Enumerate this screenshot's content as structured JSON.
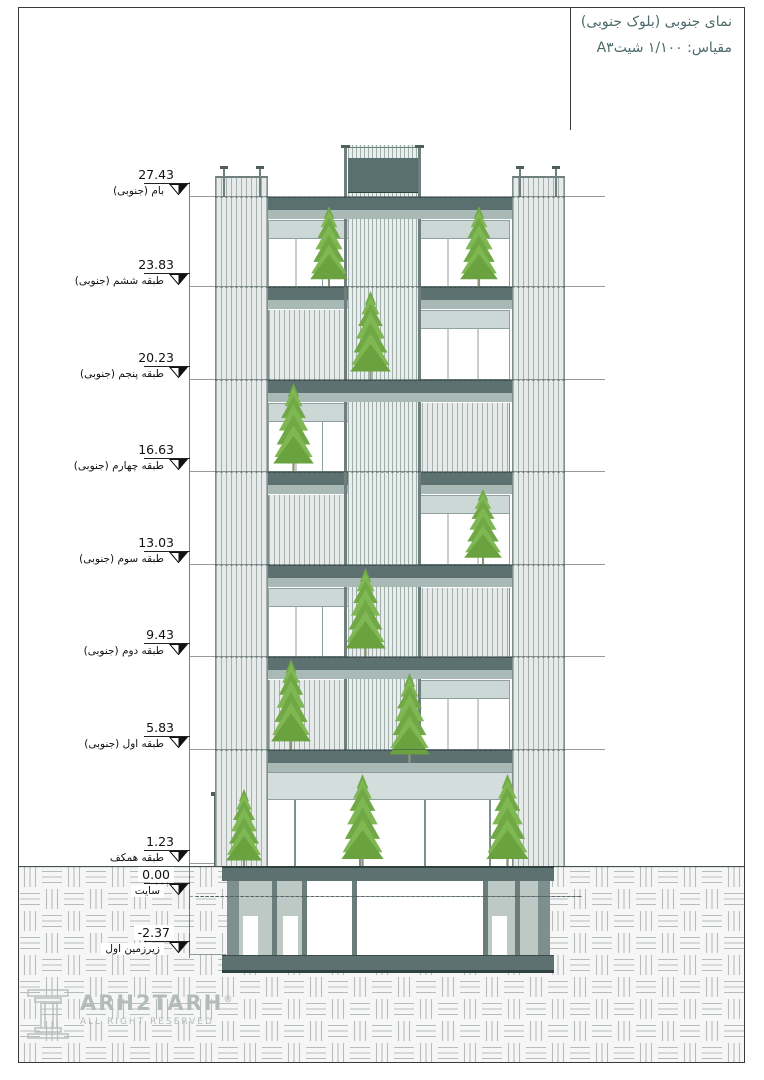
{
  "sheet": {
    "title_line1": "نمای جنوبی (بلوک جنوبی)",
    "title_line2": "مقیاس: ۱/۱۰۰ شیتA۳",
    "logo_text": "RΛDO"
  },
  "markers": [
    {
      "value": "27.43",
      "label": "بام (جنوبی)"
    },
    {
      "value": "23.83",
      "label": "طبقه ششم (جنوبی)"
    },
    {
      "value": "20.23",
      "label": "طبقه پنجم (جنوبی)"
    },
    {
      "value": "16.63",
      "label": "طبقه چهارم (جنوبی)"
    },
    {
      "value": "13.03",
      "label": "طبقه سوم (جنوبی)"
    },
    {
      "value": "9.43",
      "label": "طبقه دوم (جنوبی)"
    },
    {
      "value": "5.83",
      "label": "طبقه اول (جنوبی)"
    },
    {
      "value": "1.23",
      "label": "طبقه همکف"
    },
    {
      "value": "0.00",
      "label": "سایت"
    },
    {
      "value": "-2.37",
      "label": "زیرزمین اول"
    }
  ],
  "watermark": {
    "brand": "ARH2TARH",
    "registered": "®",
    "tagline": "ALL RIGHT RESERVED"
  },
  "colors": {
    "slab": "#5d7170",
    "sage_band": "#a9bab6",
    "louver_line": "#a6b1af",
    "window_shade": "#ccd8d6",
    "tree_green_light": "#7fb753",
    "tree_green_dark": "#6fa844",
    "title_text": "#4d6a6a",
    "marker_text": "#111111",
    "watermark_text": "#b3bcba",
    "ground_hatch_line": "#b7bdbb"
  }
}
